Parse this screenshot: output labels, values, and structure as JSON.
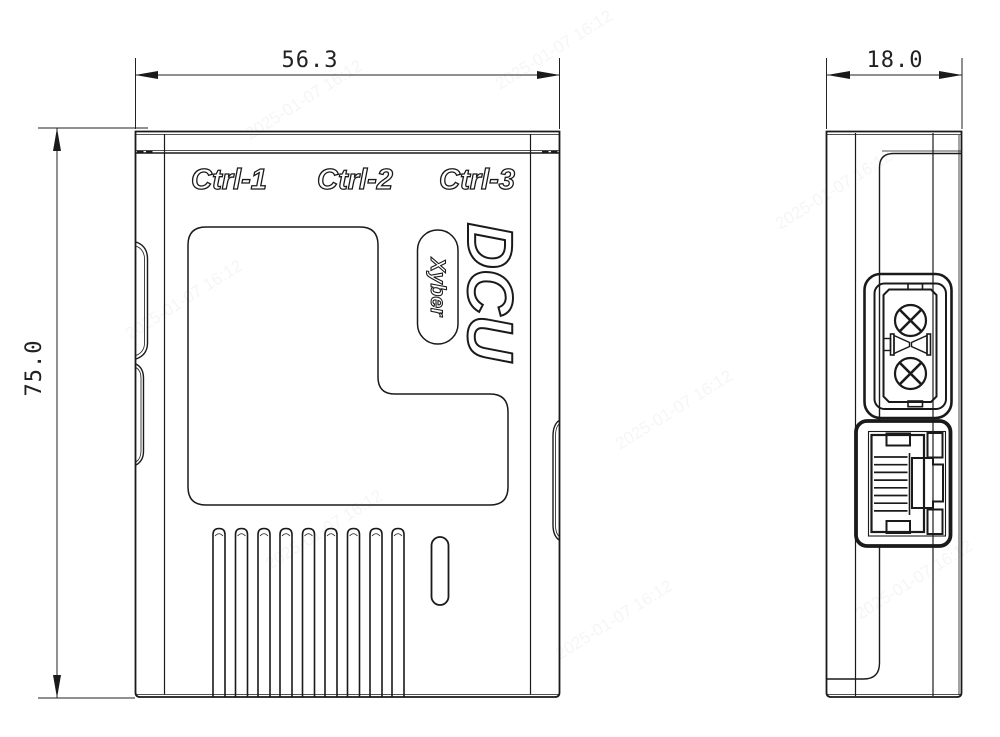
{
  "page": {
    "background": "#ffffff",
    "line_color": "#1a1a1a"
  },
  "views": {
    "front": {
      "width_dim": "56.3",
      "height_dim": "75.0",
      "port_labels": [
        "Ctrl-1",
        "Ctrl-2",
        "Ctrl-3"
      ],
      "product_name": "DCU",
      "brand": "Xyber"
    },
    "side": {
      "depth_dim": "18.0"
    }
  },
  "watermark": {
    "text": "2025-01-07 16:12"
  }
}
